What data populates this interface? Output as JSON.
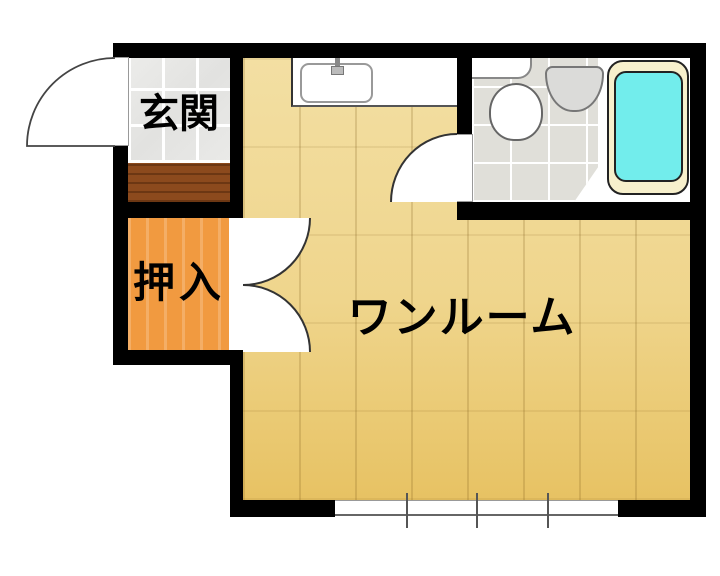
{
  "floorplan": {
    "rooms": {
      "entrance": {
        "label": "玄関"
      },
      "closet": {
        "label": "押入"
      },
      "main_room": {
        "label": "ワンルーム"
      }
    },
    "fixtures": [
      "kitchen-sink",
      "faucet",
      "toilet",
      "washbasin",
      "bathtub"
    ],
    "window": {
      "panes": 4
    },
    "colors": {
      "wall": "#000000",
      "floor_light": "#F3DFA3",
      "floor_dark": "#E7C263",
      "closet_wood": "#F19A40",
      "step_wood": "#8C4A1D",
      "entrance_tile": "#E8E8E6",
      "bathroom_tile": "#E0DFD9",
      "bathtub_rim": "#F7F0CC",
      "bathtub_water": "#72EDEC",
      "fixture_white": "#FFFFFF"
    }
  }
}
